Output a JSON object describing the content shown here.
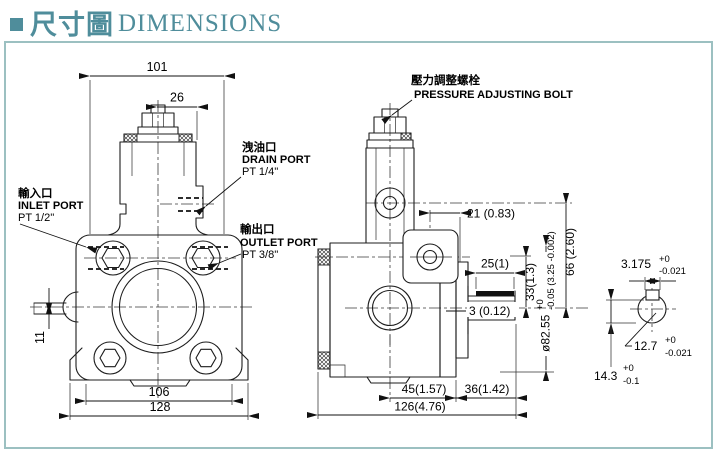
{
  "header": {
    "title_cjk": "尺寸圖",
    "title_en": "DIMENSIONS"
  },
  "colors": {
    "accent": "#4f8d9b",
    "frame_border": "#9cc0c1",
    "line": "#1c1c1c"
  },
  "icons": {
    "title_bullet": "square"
  },
  "front_view": {
    "dim_101": "101",
    "dim_26": "26",
    "dim_11": "11",
    "dim_106": "106",
    "dim_128": "128",
    "drain": {
      "cjk": "洩油口",
      "en": "DRAIN PORT",
      "thread": "PT 1/4''"
    },
    "inlet": {
      "cjk": "輸入口",
      "en": "INLET PORT",
      "thread": "PT 1/2''"
    },
    "outlet": {
      "cjk": "輸出口",
      "en": "OUTLET PORT",
      "thread": "PT 3/8''"
    }
  },
  "side_view": {
    "adjust_bolt": {
      "cjk": "壓力調整螺栓",
      "en": "PRESSURE ADJUSTING BOLT"
    },
    "dim_21": "21 (0.83)",
    "dim_66": "66 (2.60)",
    "dim_33": "33(1.3)",
    "dim_25": "25(1)",
    "dim_3": "3 (0.12)",
    "dim_45": "45(1.57)",
    "dim_36": "36(1.42)",
    "dim_126": "126(4.76)",
    "pilot": {
      "value": "ø82.55",
      "sup": "+0",
      "sub": "-0.05 (3.25 -0.002)"
    }
  },
  "shaft_detail": {
    "key_width": {
      "value": "3.175",
      "sup": "+0",
      "sub": "-0.021"
    },
    "shaft_dia": {
      "value": "12.7",
      "sup": "+0",
      "sub": "-0.021"
    },
    "key_top": {
      "value": "14.3",
      "sup": "+0",
      "sub": "-0.1"
    }
  }
}
